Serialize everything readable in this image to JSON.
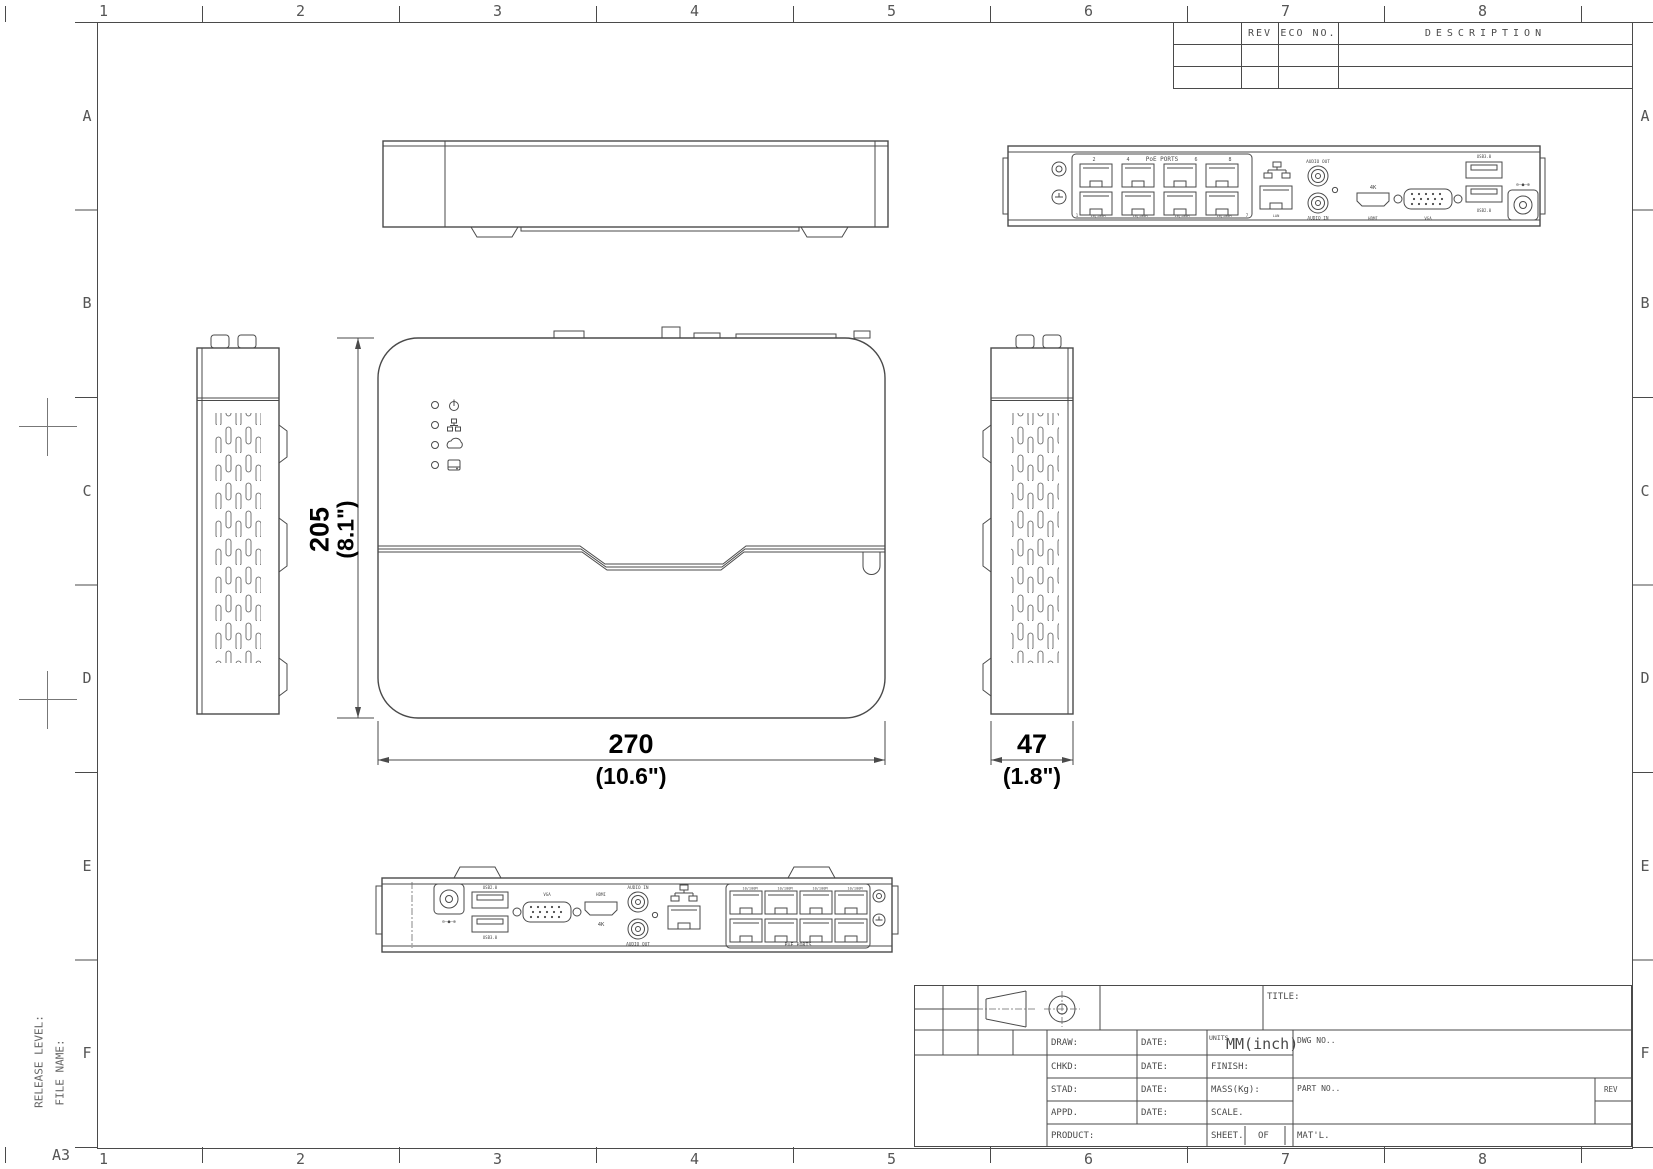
{
  "sheet": {
    "format_label": "A3",
    "release_level_label": "RELEASE LEVEL:",
    "file_name_label": "FILE NAME:",
    "zone_columns": [
      "1",
      "2",
      "3",
      "4",
      "5",
      "6",
      "7",
      "8"
    ],
    "zone_rows": [
      "A",
      "B",
      "C",
      "D",
      "E",
      "F"
    ],
    "line_color": "#4a4a4a",
    "background_color": "#ffffff"
  },
  "revision_table": {
    "rev_header": "REV",
    "eco_header": "ECO NO.",
    "description_header": "DESCRIPTION",
    "rows": [
      {
        "rev": "",
        "eco": "",
        "description": ""
      },
      {
        "rev": "",
        "eco": "",
        "description": ""
      }
    ]
  },
  "title_block": {
    "title_label": "TITLE:",
    "title_value": "",
    "draw_label": "DRAW:",
    "chkd_label": "CHKD:",
    "stad_label": "STAD:",
    "appd_label": "APPD.",
    "product_label": "PRODUCT:",
    "date_label": "DATE:",
    "units_label": "UNITS",
    "units_value": "MM(inch)",
    "dwg_no_label": "DWG NO..",
    "finish_label": "FINISH:",
    "mass_label": "MASS(Kg):",
    "part_no_label": "PART NO..",
    "rev_label": "REV",
    "scale_label": "SCALE.",
    "sheet_label": "SHEET.",
    "of_label": "OF",
    "matl_label": "MAT'L."
  },
  "dimensions": {
    "height_mm": "205",
    "height_inch": "(8.1\")",
    "width_mm": "270",
    "width_inch": "(10.6\")",
    "depth_mm": "47",
    "depth_inch": "(1.8\")"
  },
  "rear_panel": {
    "poe_ports_label": "PoE PORTS",
    "port_numbers_top": [
      "2",
      "4",
      "6",
      "8"
    ],
    "port_numbers_bottom": [
      "1",
      "7"
    ],
    "port_speed_label": "10/100M",
    "lan_label": "LAN",
    "audio_out_label": "AUDIO OUT",
    "audio_in_label": "AUDIO IN",
    "hdmi_4k_label": "4K",
    "hdmi_label": "HDMI",
    "vga_label": "VGA",
    "usb3_label": "USB3.0",
    "usb2_label": "USB2.0",
    "polarity_symbol": "⊖–●–⊕"
  },
  "top_view": {
    "led_icons": [
      "power",
      "network",
      "cloud",
      "hdd"
    ]
  }
}
